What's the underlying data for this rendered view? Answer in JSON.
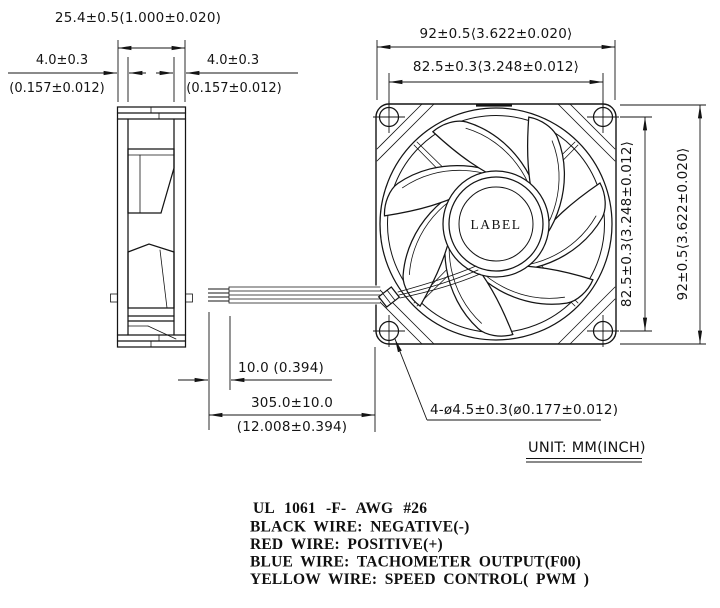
{
  "colors": {
    "ink": "#141414",
    "background": "#ffffff"
  },
  "side_view": {
    "dim_depth": "25.4±0.5(1.000±0.020)",
    "dim_flange_front": "4.0±0.3",
    "dim_flange_front_inch": "(0.157±0.012)",
    "dim_flange_rear": "4.0±0.3",
    "dim_flange_rear_inch": "(0.157±0.012)"
  },
  "front_view": {
    "hub_label": "LABEL",
    "dim_width": "92±0.5⟨3.622±0.020⟩",
    "dim_hole_pitch_h": "82.5±0.3⟨3.248±0.012⟩",
    "dim_height": "92±0.5⟨3.622±0.020⟩",
    "dim_hole_pitch_v": "82.5±0.3⟨3.248±0.012⟩",
    "dim_mounting_holes": "4-ø4.5±0.3(ø0.177±0.012)"
  },
  "leads": {
    "dim_strip_length": "10.0 (0.394)",
    "dim_length_mm": "305.0±10.0",
    "dim_length_inch": "(12.008±0.394)"
  },
  "unit_note": "UNIT: MM(INCH)",
  "wire_notes": {
    "spec": "UL 1061 -F- AWG #26",
    "black": "BLACK WIRE: NEGATIVE(-)",
    "red": "RED WIRE: POSITIVE(+)",
    "blue": "BLUE WIRE: TACHOMETER OUTPUT(F00)",
    "yellow": "YELLOW WIRE: SPEED CONTROL( PWM )"
  }
}
